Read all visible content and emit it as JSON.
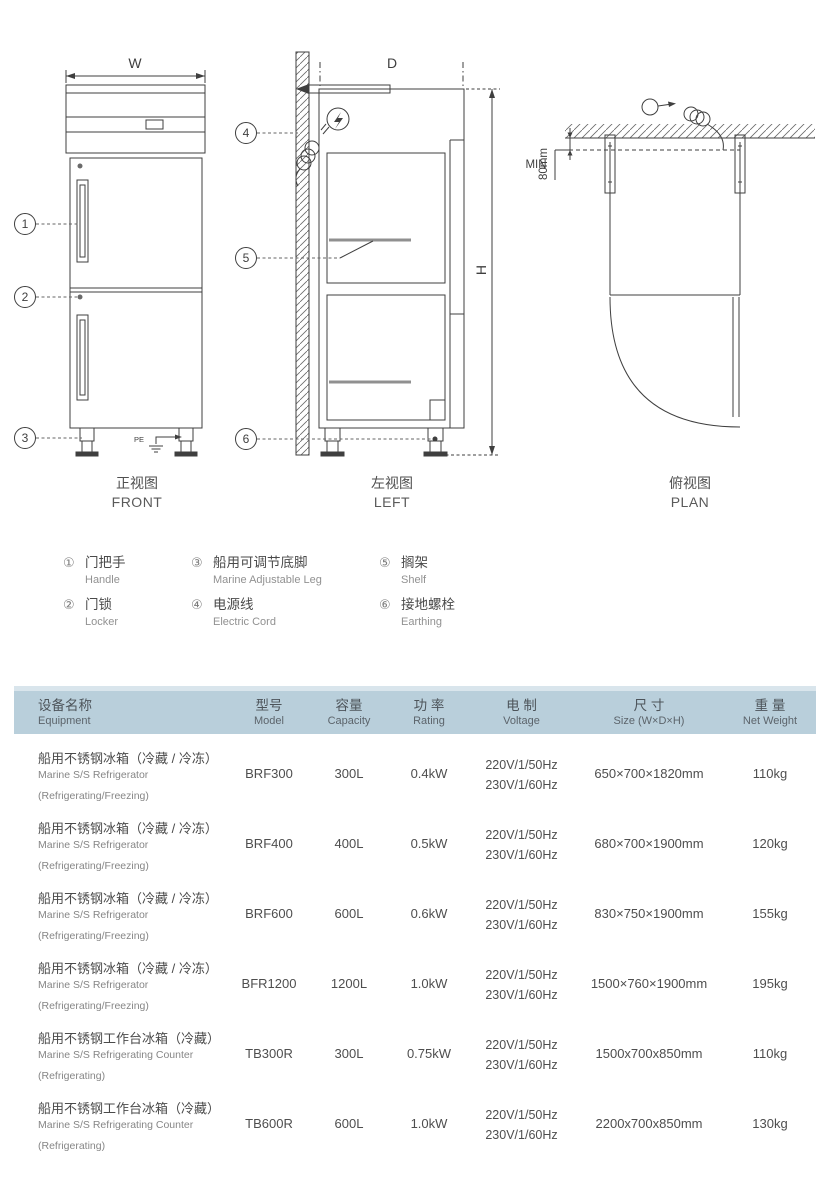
{
  "colors": {
    "header_bg": "#b9cfdb",
    "header_strip": "#d9e5ec",
    "line": "#3f3f3f",
    "text_dark": "#4a4a4a",
    "text_light": "#8c8c8c",
    "shelf": "#909090"
  },
  "views": {
    "front": {
      "cn": "正视图",
      "en": "FRONT",
      "dim_w": "W",
      "pe": "PE",
      "c1": "1",
      "c2": "2",
      "c3": "3"
    },
    "left": {
      "cn": "左视图",
      "en": "LEFT",
      "dim_d": "D",
      "dim_h": "H",
      "c4": "4",
      "c5": "5",
      "c6": "6"
    },
    "plan": {
      "cn": "俯视图",
      "en": "PLAN",
      "min": "MIN",
      "gap": "80mm"
    }
  },
  "legend": {
    "items": [
      {
        "num": "①",
        "cn": "门把手",
        "en": "Handle"
      },
      {
        "num": "②",
        "cn": "门锁",
        "en": "Locker"
      },
      {
        "num": "③",
        "cn": "船用可调节底脚",
        "en": "Marine Adjustable Leg"
      },
      {
        "num": "④",
        "cn": "电源线",
        "en": "Electric Cord"
      },
      {
        "num": "⑤",
        "cn": "搁架",
        "en": "Shelf"
      },
      {
        "num": "⑥",
        "cn": "接地螺栓",
        "en": "Earthing"
      }
    ]
  },
  "table": {
    "headers": [
      {
        "cn": "设备名称",
        "en": "Equipment"
      },
      {
        "cn": "型号",
        "en": "Model"
      },
      {
        "cn": "容量",
        "en": "Capacity"
      },
      {
        "cn": "功 率",
        "en": "Rating"
      },
      {
        "cn": "电 制",
        "en": "Voltage"
      },
      {
        "cn": "尺 寸",
        "en": "Size (W×D×H)"
      },
      {
        "cn": "重 量",
        "en": "Net Weight"
      }
    ],
    "rows": [
      {
        "name_cn": "船用不锈钢冰箱（冷藏 / 冷冻）",
        "name_en": "Marine S/S Refrigerator",
        "name_note": "(Refrigerating/Freezing)",
        "model": "BRF300",
        "capacity": "300L",
        "rating": "0.4kW",
        "voltage1": "220V/1/50Hz",
        "voltage2": "230V/1/60Hz",
        "size": "650×700×1820mm",
        "weight": "110kg"
      },
      {
        "name_cn": "船用不锈钢冰箱（冷藏 / 冷冻）",
        "name_en": "Marine S/S Refrigerator",
        "name_note": "(Refrigerating/Freezing)",
        "model": "BRF400",
        "capacity": "400L",
        "rating": "0.5kW",
        "voltage1": "220V/1/50Hz",
        "voltage2": "230V/1/60Hz",
        "size": "680×700×1900mm",
        "weight": "120kg"
      },
      {
        "name_cn": "船用不锈钢冰箱（冷藏 / 冷冻）",
        "name_en": "Marine S/S Refrigerator",
        "name_note": "(Refrigerating/Freezing)",
        "model": "BRF600",
        "capacity": "600L",
        "rating": "0.6kW",
        "voltage1": "220V/1/50Hz",
        "voltage2": "230V/1/60Hz",
        "size": "830×750×1900mm",
        "weight": "155kg"
      },
      {
        "name_cn": "船用不锈钢冰箱（冷藏 / 冷冻）",
        "name_en": "Marine S/S Refrigerator",
        "name_note": "(Refrigerating/Freezing)",
        "model": "BFR1200",
        "capacity": "1200L",
        "rating": "1.0kW",
        "voltage1": "220V/1/50Hz",
        "voltage2": "230V/1/60Hz",
        "size": "1500×760×1900mm",
        "weight": "195kg"
      },
      {
        "name_cn": "船用不锈钢工作台冰箱（冷藏）",
        "name_en": "Marine S/S Refrigerating Counter",
        "name_note": "(Refrigerating)",
        "model": "TB300R",
        "capacity": "300L",
        "rating": "0.75kW",
        "voltage1": "220V/1/50Hz",
        "voltage2": "230V/1/60Hz",
        "size": "1500x700x850mm",
        "weight": "110kg"
      },
      {
        "name_cn": "船用不锈钢工作台冰箱（冷藏）",
        "name_en": "Marine S/S Refrigerating Counter",
        "name_note": "(Refrigerating)",
        "model": "TB600R",
        "capacity": "600L",
        "rating": "1.0kW",
        "voltage1": "220V/1/50Hz",
        "voltage2": "230V/1/60Hz",
        "size": "2200x700x850mm",
        "weight": "130kg"
      }
    ]
  }
}
